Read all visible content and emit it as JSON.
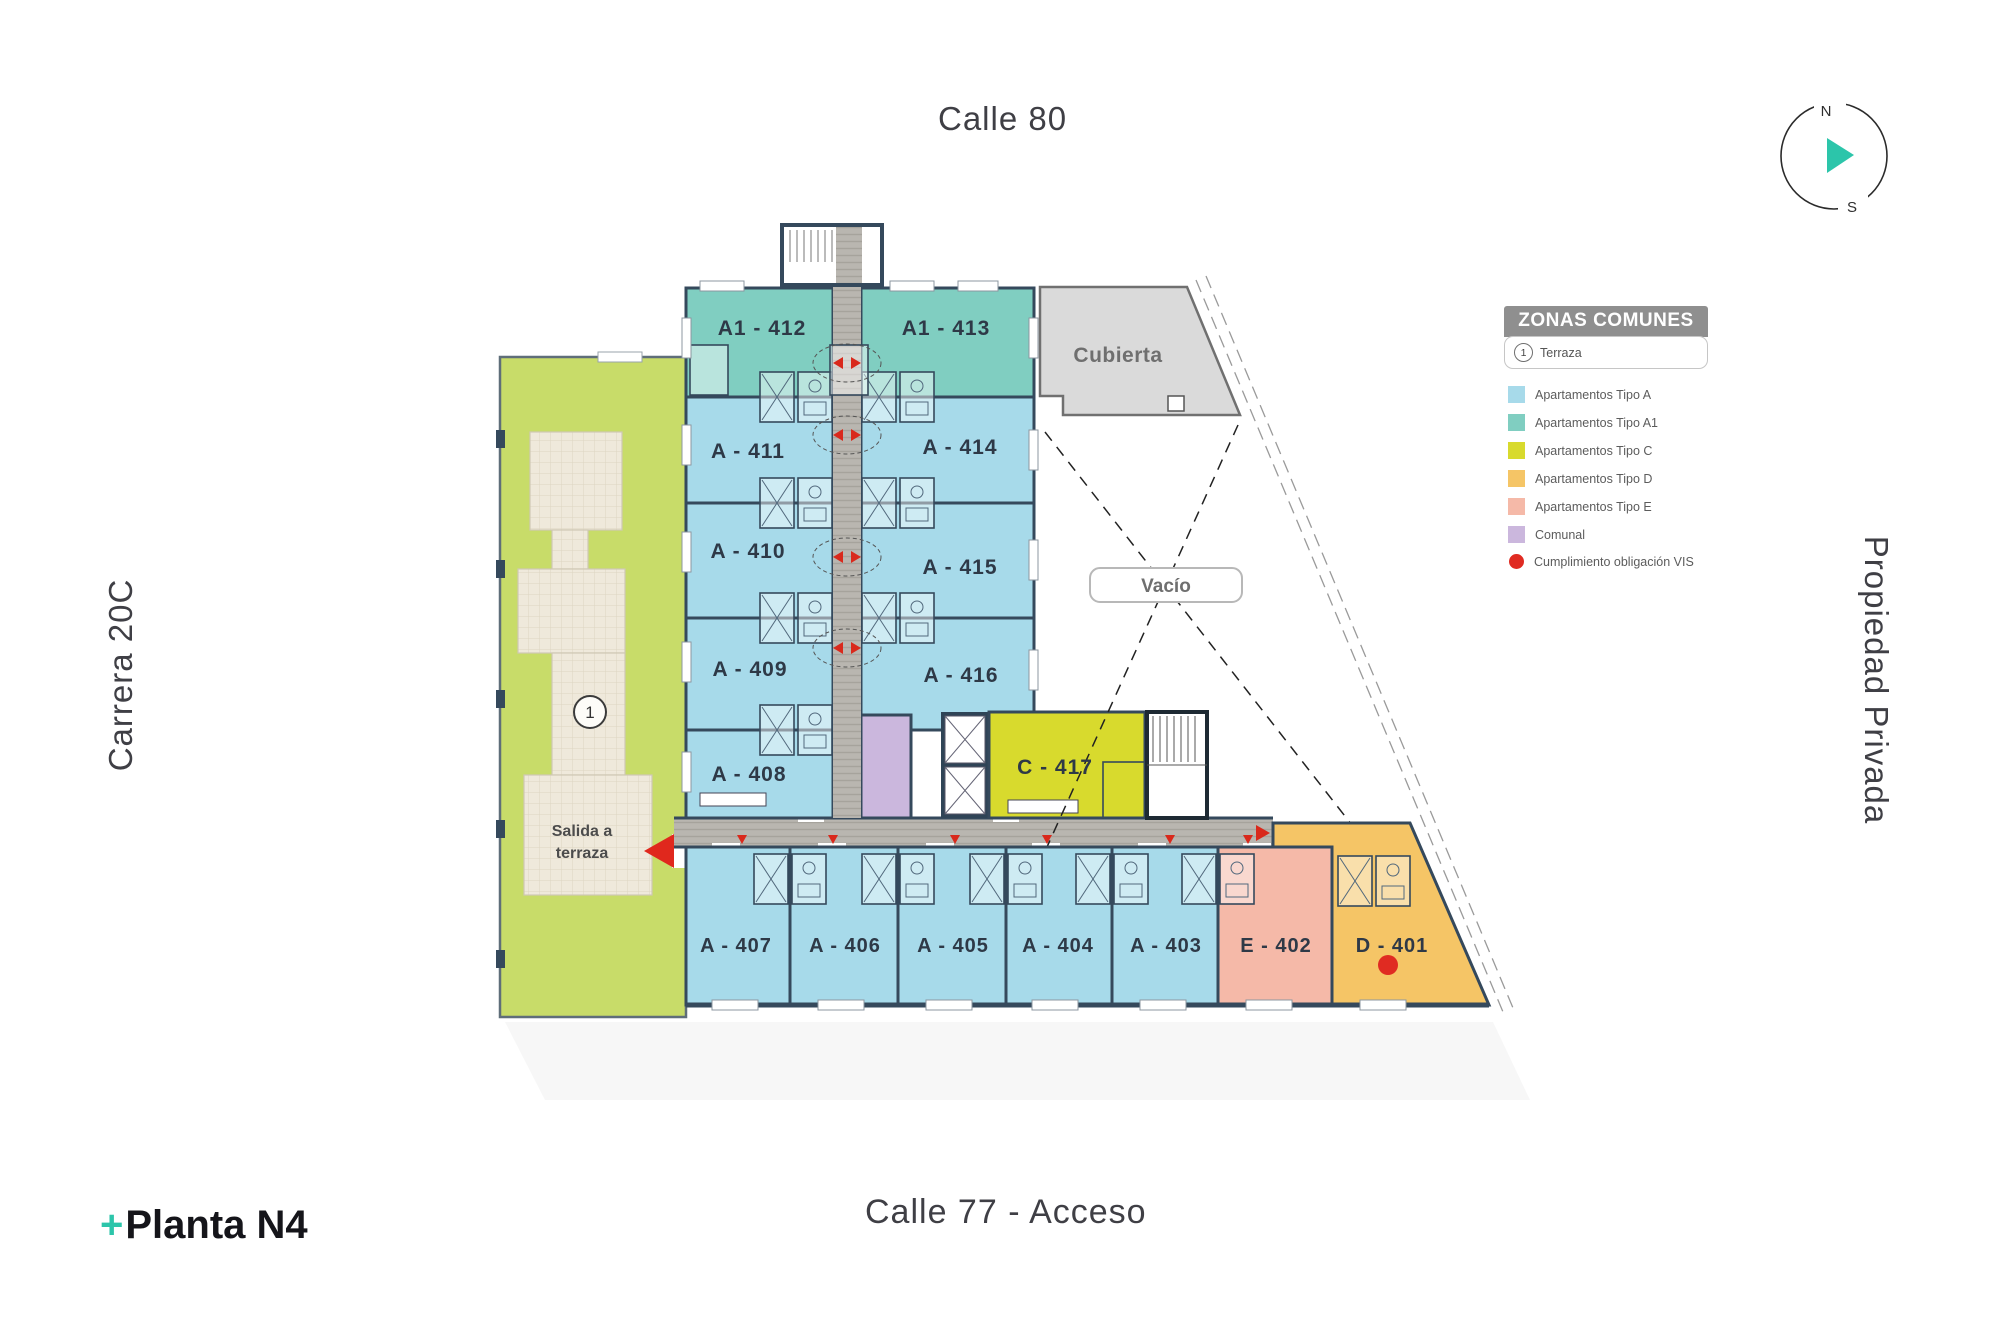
{
  "page": {
    "background": "#ffffff"
  },
  "streets": {
    "top": "Calle 80",
    "left": "Carrera 20C",
    "right": "Propiedad Privada",
    "bottom": "Calle 77 - Acceso"
  },
  "title": {
    "plus": "+",
    "label": "Planta N4"
  },
  "compass": {
    "north": "N",
    "south": "S"
  },
  "legend": {
    "header": "ZONAS COMUNES",
    "terraza": {
      "number": "1",
      "label": "Terraza"
    },
    "items": [
      {
        "label": "Apartamentos Tipo A",
        "color": "#a7daea"
      },
      {
        "label": "Apartamentos Tipo A1",
        "color": "#80cec1"
      },
      {
        "label": "Apartamentos Tipo C",
        "color": "#d8da2d"
      },
      {
        "label": "Apartamentos Tipo D",
        "color": "#f5c566"
      },
      {
        "label": "Apartamentos Tipo E",
        "color": "#f5b9a8"
      },
      {
        "label": "Comunal",
        "color": "#cbb7dd"
      }
    ],
    "vis": {
      "label": "Cumplimiento obligación VIS",
      "color": "#e02b22"
    }
  },
  "plan": {
    "terrace_marker": "1",
    "areas": {
      "cubierta": "Cubierta",
      "vacio": "Vacío",
      "salida_line1": "Salida a",
      "salida_line2": "terraza"
    },
    "units": [
      {
        "id": "A1-412",
        "label": "A1 - 412",
        "type": "A1"
      },
      {
        "id": "A1-413",
        "label": "A1 - 413",
        "type": "A1"
      },
      {
        "id": "A-411",
        "label": "A - 411",
        "type": "A"
      },
      {
        "id": "A-414",
        "label": "A - 414",
        "type": "A"
      },
      {
        "id": "A-410",
        "label": "A - 410",
        "type": "A"
      },
      {
        "id": "A-415",
        "label": "A - 415",
        "type": "A"
      },
      {
        "id": "A-409",
        "label": "A - 409",
        "type": "A"
      },
      {
        "id": "A-416",
        "label": "A - 416",
        "type": "A"
      },
      {
        "id": "A-408",
        "label": "A - 408",
        "type": "A"
      },
      {
        "id": "C-417",
        "label": "C - 417",
        "type": "C"
      },
      {
        "id": "A-407",
        "label": "A - 407",
        "type": "A"
      },
      {
        "id": "A-406",
        "label": "A - 406",
        "type": "A"
      },
      {
        "id": "A-405",
        "label": "A - 405",
        "type": "A"
      },
      {
        "id": "A-404",
        "label": "A - 404",
        "type": "A"
      },
      {
        "id": "A-403",
        "label": "A - 403",
        "type": "A"
      },
      {
        "id": "E-402",
        "label": "E - 402",
        "type": "E"
      },
      {
        "id": "D-401",
        "label": "D - 401",
        "type": "D"
      }
    ],
    "colors": {
      "tipo_a": "#a7daea",
      "tipo_a1": "#80cec1",
      "tipo_c": "#d8da2d",
      "tipo_d": "#f5c566",
      "tipo_e": "#f5b9a8",
      "comunal": "#cbb7dd",
      "terrace": "#c8dc69",
      "corridor": "#b7b4ae",
      "cubierta": "#dadada",
      "wall": "#35495c",
      "vis_red": "#e02b22"
    }
  }
}
